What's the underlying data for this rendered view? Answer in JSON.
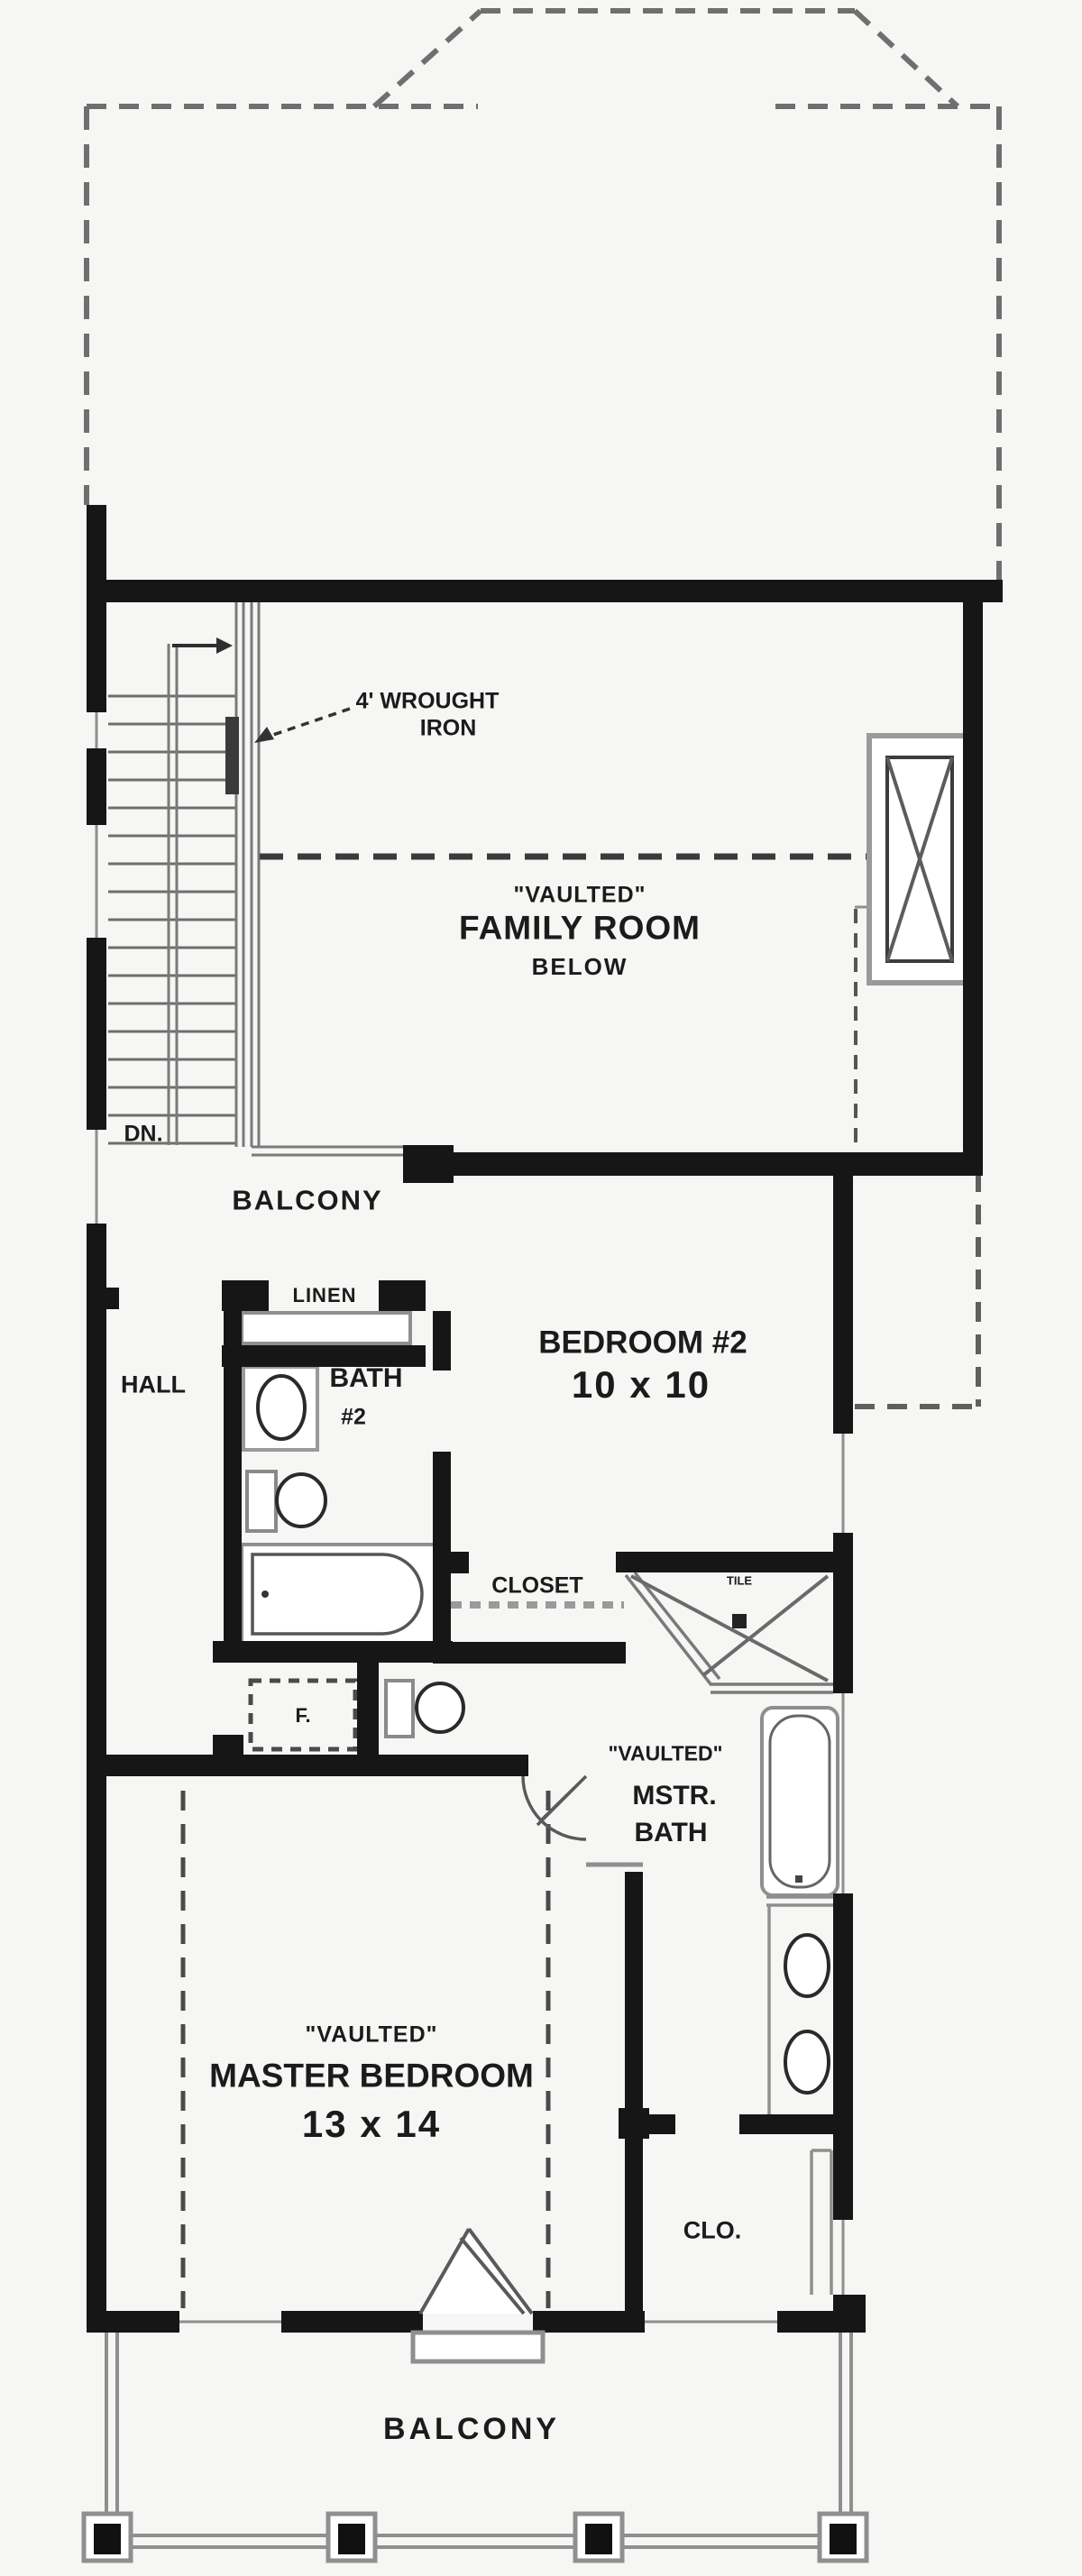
{
  "colors": {
    "wall": "#161616",
    "thin_line": "#8f8f8f",
    "dash_line": "#4a4a4a",
    "text": "#1b1b1b",
    "background": "#f6f6f4"
  },
  "labels": {
    "stair_note_line1": "4' WROUGHT",
    "stair_note_line2": "IRON",
    "stair_direction": "DN.",
    "family_room": {
      "ceiling": "\"VAULTED\"",
      "name": "FAMILY ROOM",
      "position": "BELOW"
    },
    "balcony_interior": "BALCONY",
    "linen": "LINEN",
    "hall": "HALL",
    "bath2": {
      "name": "BATH",
      "number": "#2"
    },
    "bedroom2": {
      "name": "BEDROOM #2",
      "dimensions": "10 x 10"
    },
    "closet": "CLOSET",
    "shower": "TILE",
    "master_bath": {
      "ceiling": "\"VAULTED\"",
      "line1": "MSTR.",
      "line2": "BATH"
    },
    "furnace": "F.",
    "master_bedroom": {
      "ceiling": "\"VAULTED\"",
      "name": "MASTER BEDROOM",
      "dimensions": "13 x 14"
    },
    "master_closet": "CLO.",
    "balcony_exterior": "BALCONY"
  }
}
